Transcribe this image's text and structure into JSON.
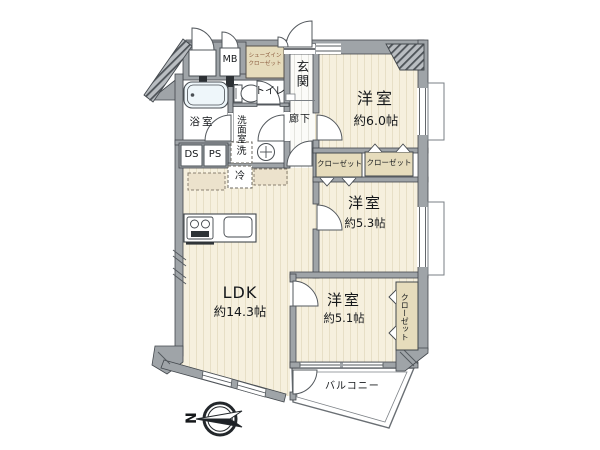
{
  "plan": {
    "rooms": {
      "ldk": {
        "name": "LDK",
        "size": "約14.3帖"
      },
      "western_6": {
        "name": "洋室",
        "size": "約6.0帖"
      },
      "western_53": {
        "name": "洋室",
        "size": "約5.3帖"
      },
      "western_51": {
        "name": "洋室",
        "size": "約5.1帖"
      },
      "bathroom": "浴室",
      "toilet": "トイレ",
      "washroom": "洗面室",
      "hallway": "廊下",
      "entrance": "玄関",
      "balcony": "バルコニー"
    },
    "storage": {
      "shoe_closet_line1": "シューズイン",
      "shoe_closet_line2": "クローゼット",
      "closet_a": "クローゼット",
      "closet_b": "クローゼット",
      "closet_51": "クローゼット"
    },
    "utilities": {
      "meter_box": "MB",
      "duct_space": "DS",
      "pipe_space": "PS",
      "washer": "洗",
      "refrigerator": "冷"
    },
    "compass": {
      "north": "N"
    },
    "colors": {
      "room_cream": "#f6f0de",
      "wet_blue": "#d9e8f0",
      "closet_beige": "#e6dcbc",
      "wall_gray": "#9fa4a8",
      "outline": "#42474c"
    }
  }
}
